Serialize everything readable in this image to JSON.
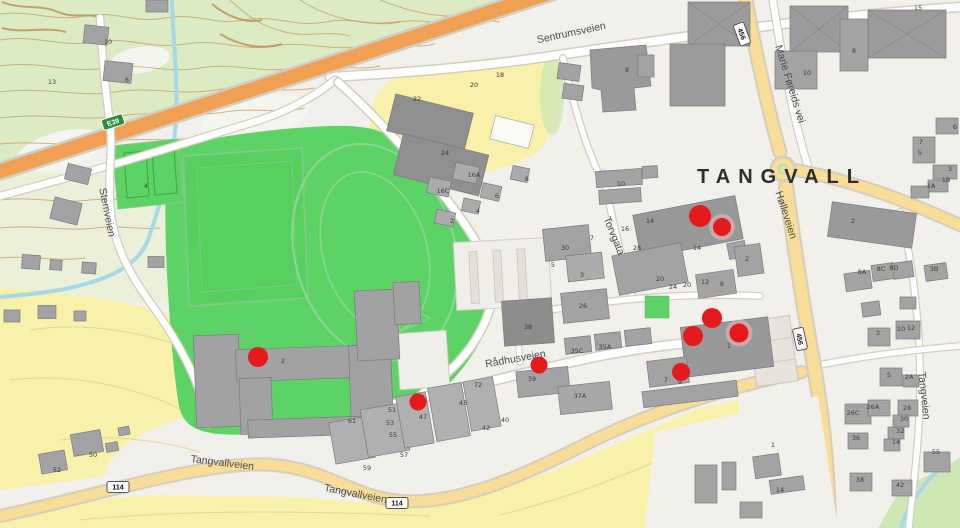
{
  "map": {
    "place_label": "TANGVALL",
    "street_labels": [
      {
        "name": "Sentrumsveien",
        "x": 572,
        "y": 36,
        "rotate": -12
      },
      {
        "name": "Stemveien",
        "x": 104,
        "y": 213,
        "rotate": 79
      },
      {
        "name": "Marie Føreids vei",
        "x": 787,
        "y": 85,
        "rotate": 73
      },
      {
        "name": "Hølleveien",
        "x": 783,
        "y": 216,
        "rotate": 72
      },
      {
        "name": "Torvgata",
        "x": 611,
        "y": 237,
        "rotate": 68
      },
      {
        "name": "Rådhusveien",
        "x": 516,
        "y": 362,
        "rotate": -10
      },
      {
        "name": "Tangvallveien",
        "x": 222,
        "y": 466,
        "rotate": 7
      },
      {
        "name": "Tangvallveien",
        "x": 355,
        "y": 497,
        "rotate": 11
      },
      {
        "name": "Tangveien",
        "x": 921,
        "y": 396,
        "rotate": 84
      }
    ],
    "road_badges": [
      {
        "text": "E39",
        "x": 113,
        "y": 122,
        "type": "european",
        "rotate": -18
      },
      {
        "text": "114",
        "x": 118,
        "y": 487,
        "type": "local",
        "rotate": 0
      },
      {
        "text": "114",
        "x": 397,
        "y": 503,
        "type": "local",
        "rotate": 0
      },
      {
        "text": "456",
        "x": 742,
        "y": 34,
        "type": "local",
        "rotate": 70
      },
      {
        "text": "456",
        "x": 800,
        "y": 339,
        "type": "local",
        "rotate": 78
      }
    ],
    "markers": [
      {
        "x": 258,
        "y": 357,
        "r": 10
      },
      {
        "x": 418,
        "y": 402,
        "r": 8.5
      },
      {
        "x": 539,
        "y": 365,
        "r": 8.5
      },
      {
        "x": 700,
        "y": 216,
        "r": 11
      },
      {
        "x": 722,
        "y": 227,
        "r": 9,
        "halo": true
      },
      {
        "x": 712,
        "y": 318,
        "r": 10
      },
      {
        "x": 693,
        "y": 336,
        "r": 10
      },
      {
        "x": 739,
        "y": 333,
        "r": 9.5,
        "halo": true
      },
      {
        "x": 681,
        "y": 372,
        "r": 9
      }
    ],
    "house_numbers": [
      {
        "n": "13",
        "x": 52,
        "y": 84
      },
      {
        "n": "10",
        "x": 108,
        "y": 44
      },
      {
        "n": "6",
        "x": 127,
        "y": 82
      },
      {
        "n": "4",
        "x": 146,
        "y": 188
      },
      {
        "n": "2",
        "x": 283,
        "y": 363
      },
      {
        "n": "52",
        "x": 57,
        "y": 472
      },
      {
        "n": "50",
        "x": 93,
        "y": 457
      },
      {
        "n": "22",
        "x": 417,
        "y": 101
      },
      {
        "n": "24",
        "x": 445,
        "y": 155
      },
      {
        "n": "20",
        "x": 474,
        "y": 87
      },
      {
        "n": "18",
        "x": 500,
        "y": 77
      },
      {
        "n": "8",
        "x": 627,
        "y": 72
      },
      {
        "n": "16A",
        "x": 474,
        "y": 177
      },
      {
        "n": "16C",
        "x": 443,
        "y": 193
      },
      {
        "n": "8",
        "x": 527,
        "y": 181
      },
      {
        "n": "6",
        "x": 497,
        "y": 198
      },
      {
        "n": "4",
        "x": 478,
        "y": 213
      },
      {
        "n": "2",
        "x": 452,
        "y": 223
      },
      {
        "n": "30",
        "x": 565,
        "y": 250
      },
      {
        "n": "7",
        "x": 592,
        "y": 240
      },
      {
        "n": "5",
        "x": 553,
        "y": 267
      },
      {
        "n": "3",
        "x": 582,
        "y": 277
      },
      {
        "n": "26",
        "x": 583,
        "y": 308
      },
      {
        "n": "38",
        "x": 528,
        "y": 329
      },
      {
        "n": "39",
        "x": 532,
        "y": 381
      },
      {
        "n": "35C",
        "x": 577,
        "y": 353
      },
      {
        "n": "35A",
        "x": 605,
        "y": 349
      },
      {
        "n": "37A",
        "x": 580,
        "y": 398
      },
      {
        "n": "61",
        "x": 352,
        "y": 423
      },
      {
        "n": "51",
        "x": 392,
        "y": 412
      },
      {
        "n": "53",
        "x": 390,
        "y": 425
      },
      {
        "n": "55",
        "x": 393,
        "y": 437
      },
      {
        "n": "57",
        "x": 404,
        "y": 457
      },
      {
        "n": "59",
        "x": 367,
        "y": 470
      },
      {
        "n": "47",
        "x": 423,
        "y": 419
      },
      {
        "n": "43",
        "x": 463,
        "y": 405
      },
      {
        "n": "72",
        "x": 478,
        "y": 387
      },
      {
        "n": "42",
        "x": 486,
        "y": 430
      },
      {
        "n": "40",
        "x": 505,
        "y": 422
      },
      {
        "n": "10",
        "x": 621,
        "y": 186
      },
      {
        "n": "16",
        "x": 625,
        "y": 231
      },
      {
        "n": "14",
        "x": 650,
        "y": 223
      },
      {
        "n": "28",
        "x": 637,
        "y": 250
      },
      {
        "n": "14",
        "x": 697,
        "y": 250
      },
      {
        "n": "20",
        "x": 660,
        "y": 281
      },
      {
        "n": "24",
        "x": 673,
        "y": 289
      },
      {
        "n": "20",
        "x": 687,
        "y": 287
      },
      {
        "n": "12",
        "x": 705,
        "y": 284
      },
      {
        "n": "8",
        "x": 722,
        "y": 286
      },
      {
        "n": "2",
        "x": 747,
        "y": 261
      },
      {
        "n": "1",
        "x": 729,
        "y": 348
      },
      {
        "n": "7",
        "x": 666,
        "y": 382
      },
      {
        "n": "9",
        "x": 680,
        "y": 384
      },
      {
        "n": "15",
        "x": 918,
        "y": 10
      },
      {
        "n": "8",
        "x": 854,
        "y": 53
      },
      {
        "n": "10",
        "x": 807,
        "y": 75
      },
      {
        "n": "6",
        "x": 955,
        "y": 129
      },
      {
        "n": "7",
        "x": 921,
        "y": 144
      },
      {
        "n": "5",
        "x": 920,
        "y": 155
      },
      {
        "n": "3",
        "x": 950,
        "y": 171
      },
      {
        "n": "1B",
        "x": 946,
        "y": 182
      },
      {
        "n": "1A",
        "x": 931,
        "y": 188
      },
      {
        "n": "2",
        "x": 853,
        "y": 223
      },
      {
        "n": "8A",
        "x": 862,
        "y": 274
      },
      {
        "n": "8C",
        "x": 881,
        "y": 271
      },
      {
        "n": "8D",
        "x": 894,
        "y": 270
      },
      {
        "n": "3B",
        "x": 934,
        "y": 271
      },
      {
        "n": "3",
        "x": 878,
        "y": 335
      },
      {
        "n": "10",
        "x": 901,
        "y": 331
      },
      {
        "n": "12",
        "x": 911,
        "y": 330
      },
      {
        "n": "5",
        "x": 889,
        "y": 377
      },
      {
        "n": "2A",
        "x": 909,
        "y": 379
      },
      {
        "n": "26C",
        "x": 853,
        "y": 415
      },
      {
        "n": "26A",
        "x": 873,
        "y": 409
      },
      {
        "n": "28",
        "x": 907,
        "y": 410
      },
      {
        "n": "30",
        "x": 904,
        "y": 421
      },
      {
        "n": "32",
        "x": 900,
        "y": 433
      },
      {
        "n": "14",
        "x": 896,
        "y": 444
      },
      {
        "n": "36",
        "x": 856,
        "y": 440
      },
      {
        "n": "55",
        "x": 936,
        "y": 454
      },
      {
        "n": "38",
        "x": 860,
        "y": 482
      },
      {
        "n": "42",
        "x": 900,
        "y": 487
      },
      {
        "n": "14",
        "x": 780,
        "y": 492
      },
      {
        "n": "1",
        "x": 773,
        "y": 447
      }
    ],
    "colors": {
      "marker_red": "#e41a1c",
      "marker_halo": "#f4b8c0",
      "sports_green": "#5cd364",
      "terrain_green": "#dcebc4",
      "farmland_yellow": "#f7f1a9",
      "highway_orange": "#f0a055",
      "main_road_yellow": "#f8dd99",
      "water_blue": "#a6d9e8",
      "building_gray": "#a3a3a5",
      "contour_brown": "#c49a62",
      "badge_green": "#2e8b40"
    }
  }
}
